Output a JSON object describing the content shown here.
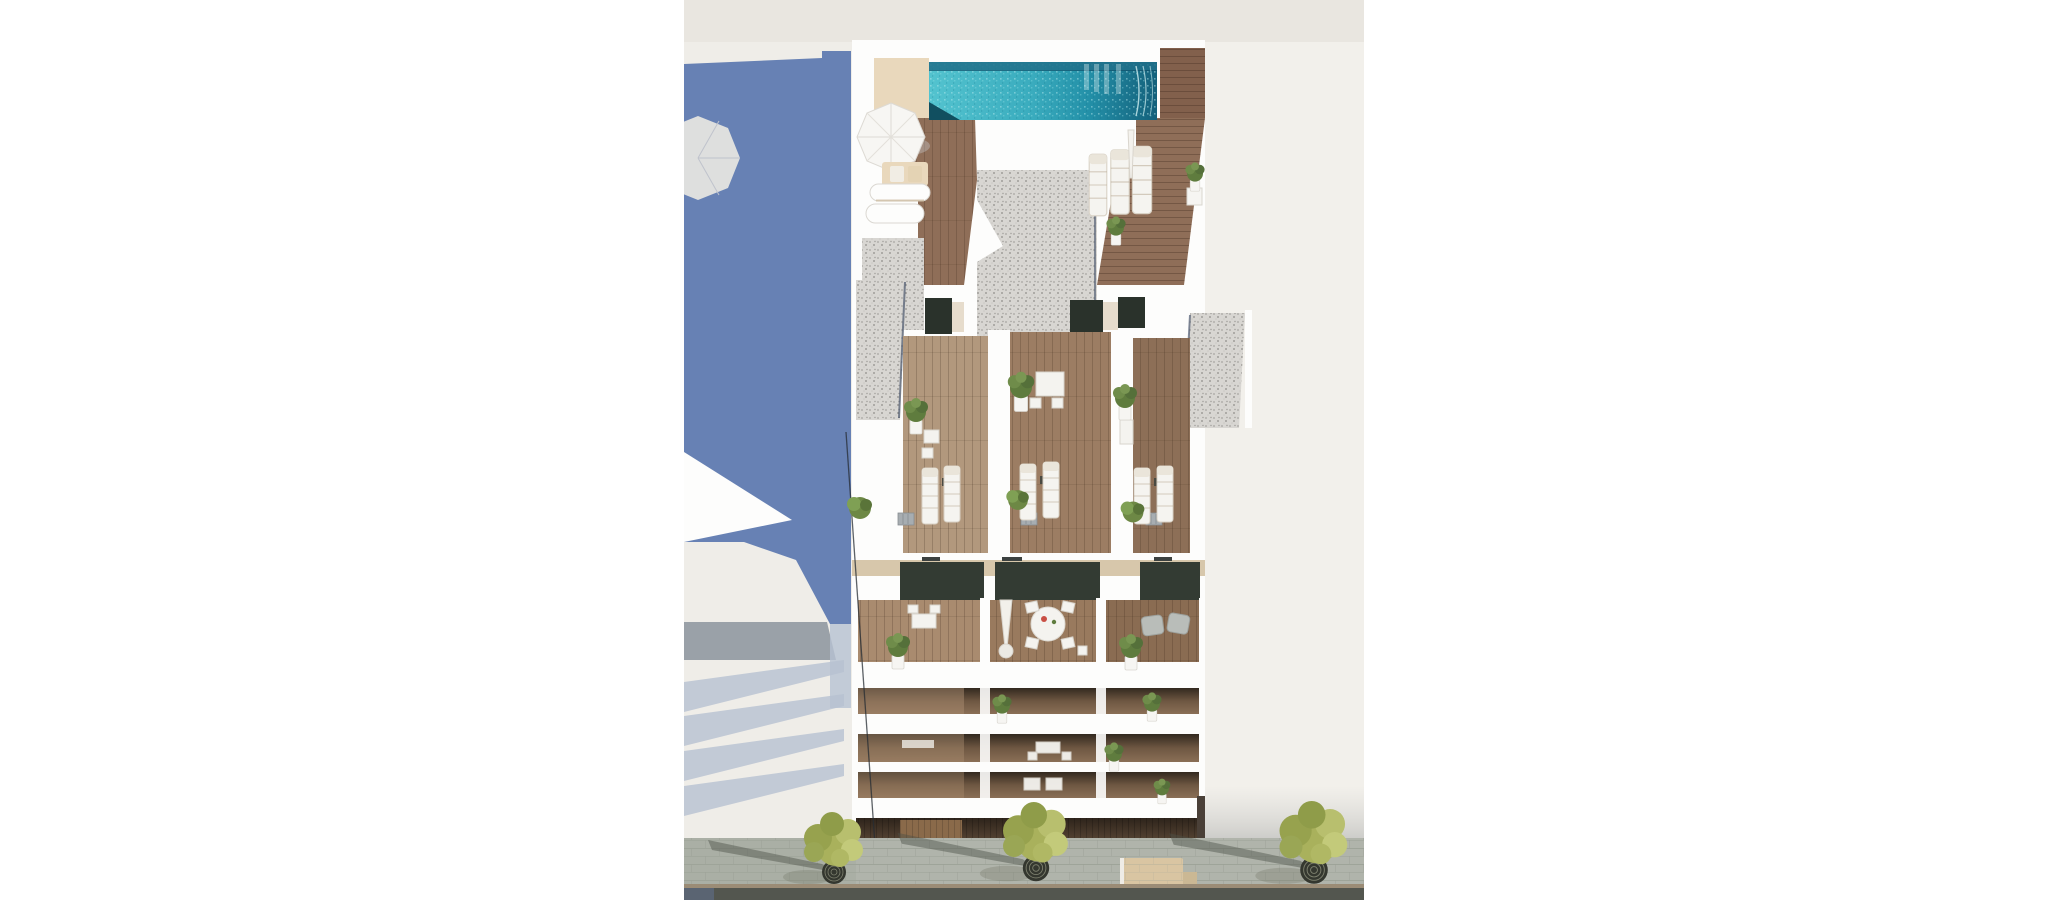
{
  "scene": {
    "description": "Aerial 3D architectural rendering of a white apartment building: rooftop terrace with turquoise pool, parasols and sun loungers; gravel roof panels; three attic terraces with wooden decking, potted plants and loungers; a furnished terrace floor and three balcony levels below; street-level pavement with trees and a bench; large blue shadow cast over the neighbouring building on the left.",
    "colors": {
      "page_bg": "#ffffff",
      "offwhite": "#efede8",
      "offwhite_top": "#e9e6e0",
      "offwhite_right": "#f2f0eb",
      "white": "#fdfdfc",
      "shadow_blue": "#6781b4",
      "slab_gray": "#9aa1a8",
      "slab_shadow": "#b7c2d2",
      "pool_1": "#53c3cf",
      "pool_2": "#3aacbe",
      "pool_3": "#2390a8",
      "pool_4": "#14607b",
      "pool_edge": "#20708a",
      "pool_dark": "#114f60",
      "pool_sparkle": "#bfeef0",
      "deck_cream": "#e9d8bc",
      "wood_deck": "#82604c",
      "wood_deck_light": "#8f6e58",
      "gravel": "#d8d6d2",
      "gravel_edge": "#33415b",
      "wood_attico_left": "#b2987d",
      "wood_attico_mid": "#9c7d63",
      "wood_attico_right": "#8d6f57",
      "door_dark": "#2a322b",
      "wall_beige": "#d7c7ab",
      "wood_terr_left": "#a98b6f",
      "wood_terr_mid": "#997a5e",
      "wood_terr_right": "#8a6c52",
      "balcony_wood": "#6e5742",
      "balcony_dark": "#3f3227",
      "glass_dark": "#333b33",
      "storefront_dark": "#43352a",
      "storefront_door": "#8a6a4a",
      "pavement": "#b0b4ab",
      "pavement_left": "#a8ada3",
      "pavement_line": "#9aa095",
      "road": "#53564f",
      "curb": "#9b8c76",
      "road_blue": "#5a6472",
      "bench": "#d9c5a2",
      "tree_g1": "#a9b15c",
      "tree_g2": "#97a24e",
      "tree_g3": "#b8bf6e",
      "tree_g4": "#8f9c49",
      "plant_green": "#5f7c3e",
      "pot_white": "#f6f5f2",
      "lounger": "#f5f4f0",
      "furn_white": "#f4f3ef",
      "furn_gray": "#b9bdb9",
      "line_dark": "#262c33",
      "shadow_soft": "#e3e0da"
    },
    "trees": [
      {
        "x": 150,
        "y": 872,
        "s": 1.0
      },
      {
        "x": 352,
        "y": 868,
        "s": 1.1
      },
      {
        "x": 630,
        "y": 870,
        "s": 1.15
      }
    ],
    "plants": [
      {
        "x": 511,
        "y": 180,
        "s": 0.8
      },
      {
        "x": 432,
        "y": 234,
        "s": 0.8
      },
      {
        "x": 232,
        "y": 420,
        "s": 1.0
      },
      {
        "x": 337,
        "y": 396,
        "s": 1.1
      },
      {
        "x": 441,
        "y": 406,
        "s": 1.0
      },
      {
        "x": 214,
        "y": 655,
        "s": 1.0
      },
      {
        "x": 447,
        "y": 656,
        "s": 1.0
      },
      {
        "x": 318,
        "y": 712,
        "s": 0.8
      },
      {
        "x": 468,
        "y": 710,
        "s": 0.8
      },
      {
        "x": 430,
        "y": 760,
        "s": 0.8
      },
      {
        "x": 478,
        "y": 794,
        "s": 0.7
      }
    ],
    "bushes": [
      {
        "x": 176,
        "y": 508,
        "s": 1.0
      },
      {
        "x": 334,
        "y": 500,
        "s": 0.9
      },
      {
        "x": 449,
        "y": 512,
        "s": 0.95
      }
    ],
    "loungers_attico": [
      {
        "x": 246,
        "y": 496,
        "s": 1.0
      },
      {
        "x": 268,
        "y": 494,
        "s": 1.0
      },
      {
        "x": 344,
        "y": 492,
        "s": 1.0
      },
      {
        "x": 367,
        "y": 490,
        "s": 1.0
      },
      {
        "x": 458,
        "y": 496,
        "s": 1.0
      },
      {
        "x": 481,
        "y": 494,
        "s": 1.0
      }
    ],
    "roof_loungers": [
      {
        "x": 414,
        "y": 185,
        "s": 1.1
      },
      {
        "x": 436,
        "y": 182,
        "s": 1.15
      },
      {
        "x": 458,
        "y": 180,
        "s": 1.2
      }
    ],
    "ac_units": [
      {
        "x": 214,
        "y": 513
      },
      {
        "x": 337,
        "y": 513
      },
      {
        "x": 462,
        "y": 513
      }
    ]
  }
}
